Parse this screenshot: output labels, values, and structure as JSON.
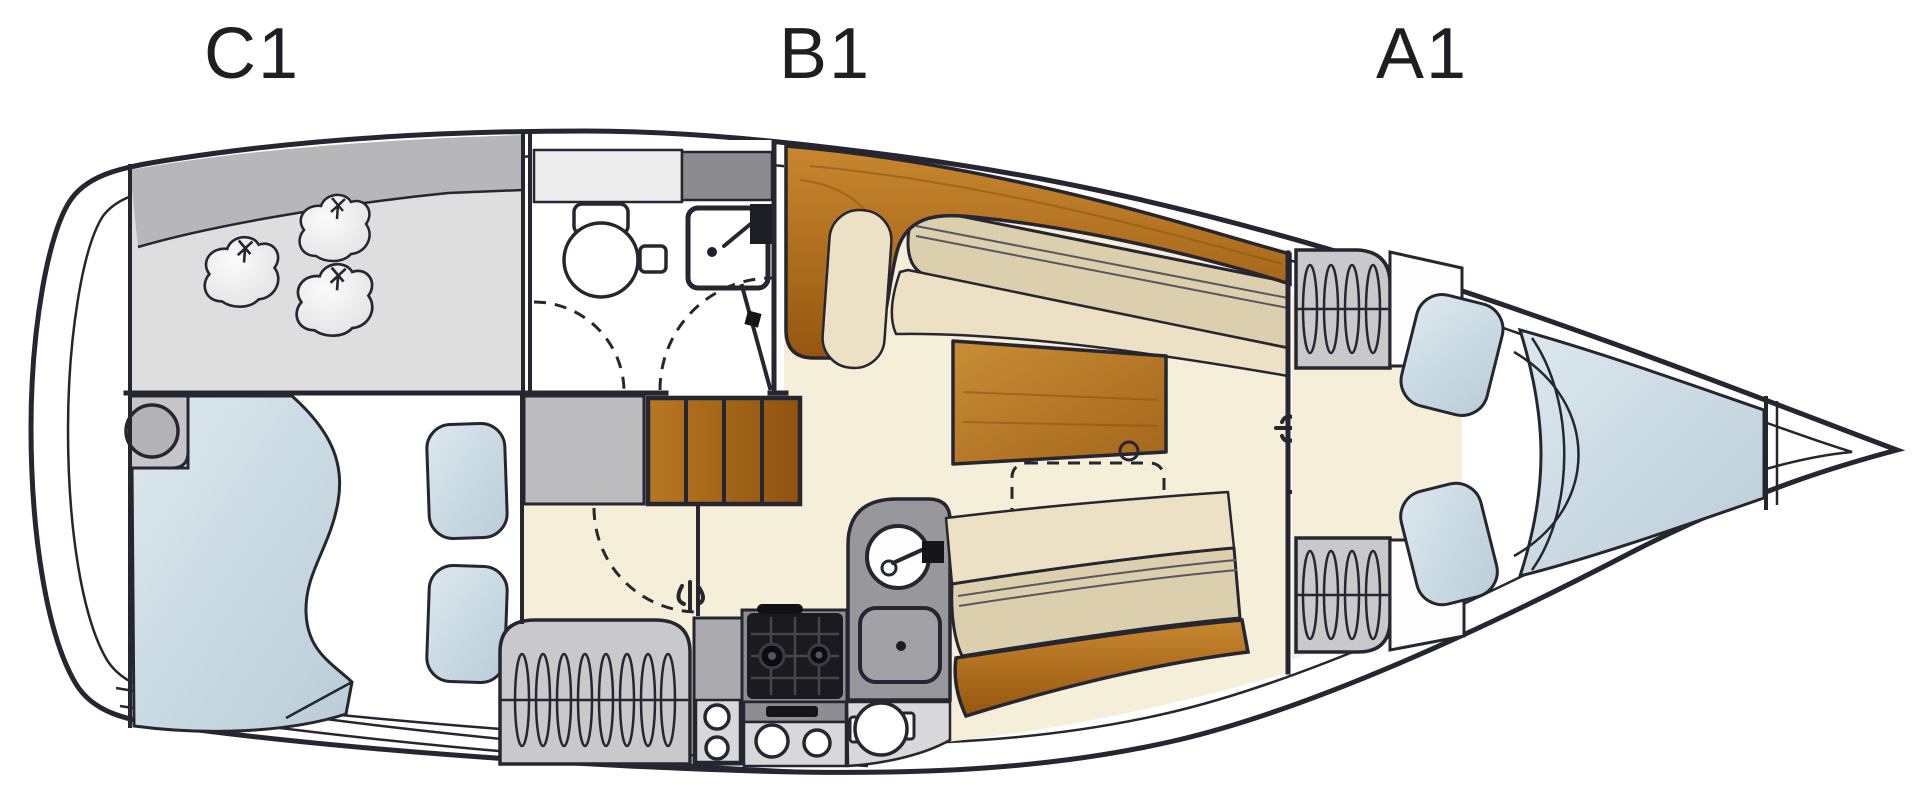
{
  "labels": {
    "c1": "C1",
    "b1": "B1",
    "a1": "A1"
  },
  "colors": {
    "outline": "#262631",
    "hull_white": "#ffffff",
    "locker_gray": "#dedede",
    "deck_band_gray": "#b7b7b9",
    "berth_blue": "#cfdfe8",
    "berth_blue_deep": "#bccfda",
    "floor_cream": "#f5eed8",
    "cushion_cream": "#ece1c4",
    "seatback_tan": "#dccfae",
    "wood": "#b97a26",
    "wood_dark": "#8a5210",
    "counter_gray": "#98989c",
    "panel_gray": "#ababaf",
    "light_gray": "#d8d8da",
    "stove_black": "#1b1b1f",
    "label_color": "#1f1f23"
  }
}
